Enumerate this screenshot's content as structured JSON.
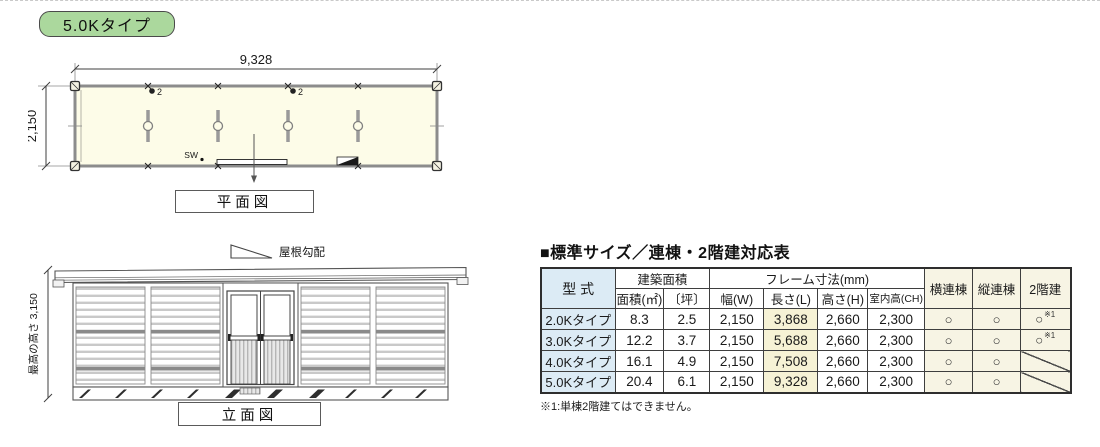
{
  "badge": {
    "label": "5.0Kタイプ"
  },
  "colors": {
    "badge_green": "#abd89d",
    "plan_fill": "#fdfce8",
    "model_blue": "#dcebf5",
    "length_yellow": "#f6f2d5",
    "option_cream": "#f7f4e4"
  },
  "floor_plan": {
    "caption": "平面図",
    "dim_width": "9,328",
    "dim_height": "2,150",
    "sw_label": "SW",
    "fixture1_label": "2",
    "fixture2_label": "2"
  },
  "elevation": {
    "caption": "立面図",
    "roof_slope_label": "屋根勾配",
    "dim_height_label": "最高の高さ 3,150"
  },
  "spec_table": {
    "title": "■標準サイズ／連棟・2階建対応表",
    "headers": {
      "model": "型 式",
      "area_group": "建築面積",
      "area_m2": "面積(㎡)",
      "area_tsubo": "〔坪〕",
      "frame_group": "フレーム寸法(mm)",
      "width_w": "幅(W)",
      "length_l": "長さ(L)",
      "height_h": "高さ(H)",
      "ceiling_ch": "室内高(CH)",
      "yoko_rento": "横連棟",
      "tate_rento": "縦連棟",
      "nikaidate": "2階建"
    },
    "rows": [
      {
        "model": "2.0Kタイプ",
        "area_m2": "8.3",
        "area_tsubo": "2.5",
        "width": "2,150",
        "length": "3,868",
        "height": "2,660",
        "ceiling": "2,300",
        "yoko": "○",
        "tate": "○",
        "nikai": "○",
        "nikai_note": "※1",
        "nikai_diagonal": "false"
      },
      {
        "model": "3.0Kタイプ",
        "area_m2": "12.2",
        "area_tsubo": "3.7",
        "width": "2,150",
        "length": "5,688",
        "height": "2,660",
        "ceiling": "2,300",
        "yoko": "○",
        "tate": "○",
        "nikai": "○",
        "nikai_note": "※1",
        "nikai_diagonal": "false"
      },
      {
        "model": "4.0Kタイプ",
        "area_m2": "16.1",
        "area_tsubo": "4.9",
        "width": "2,150",
        "length": "7,508",
        "height": "2,660",
        "ceiling": "2,300",
        "yoko": "○",
        "tate": "○",
        "nikai": "",
        "nikai_note": "",
        "nikai_diagonal": "true"
      },
      {
        "model": "5.0Kタイプ",
        "area_m2": "20.4",
        "area_tsubo": "6.1",
        "width": "2,150",
        "length": "9,328",
        "height": "2,660",
        "ceiling": "2,300",
        "yoko": "○",
        "tate": "○",
        "nikai": "",
        "nikai_note": "",
        "nikai_diagonal": "true"
      }
    ],
    "footnote": "※1:単棟2階建てはできません。"
  }
}
